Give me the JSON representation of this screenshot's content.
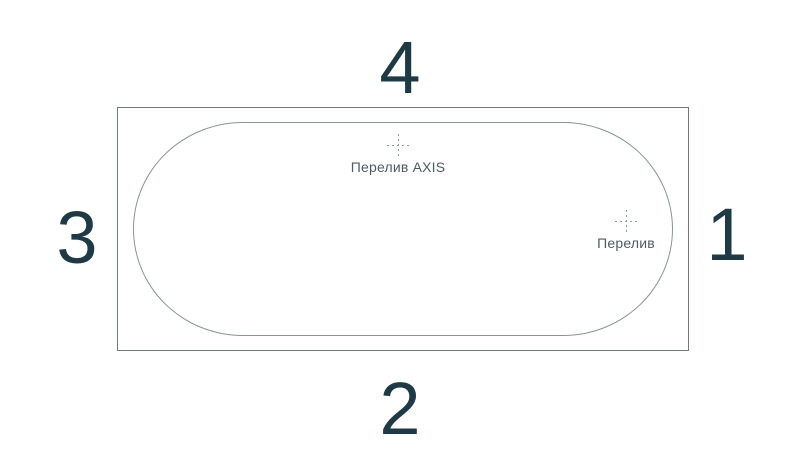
{
  "diagram": {
    "type": "bathtub-top-view",
    "sides": [
      {
        "number": "1",
        "position": "right"
      },
      {
        "number": "2",
        "position": "bottom"
      },
      {
        "number": "3",
        "position": "left"
      },
      {
        "number": "4",
        "position": "top"
      }
    ],
    "markers": [
      {
        "name": "overflow-axis",
        "label": "Перелив AXIS"
      },
      {
        "name": "overflow",
        "label": "Перелив"
      }
    ],
    "colors": {
      "background": "#ffffff",
      "number_text": "#1f3a44",
      "marker_text": "#4e5c63",
      "outer_outline": "#6d7c7a",
      "rim_outline": "#8a9492",
      "crosshair": "#8f9c9c"
    }
  }
}
